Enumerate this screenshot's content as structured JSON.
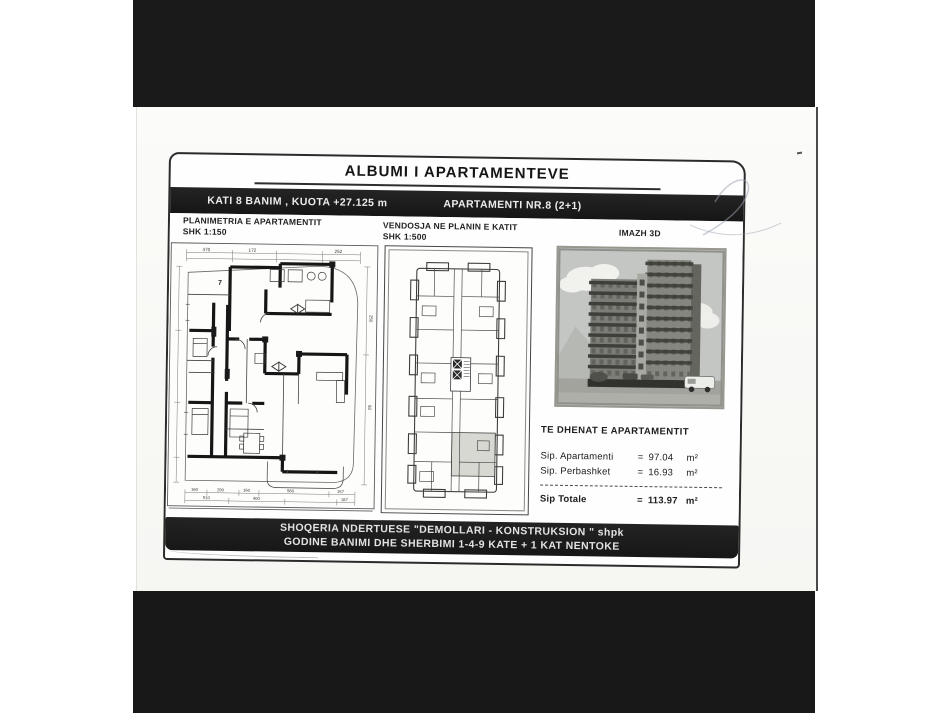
{
  "scan": {
    "background_color": "#ffffff",
    "band_color": "#1a1a1a",
    "page_color": "#fbfbf9",
    "ink_color": "#1a1a1a"
  },
  "document": {
    "title": "ALBUMI I APARTAMENTEVE",
    "header_bar": {
      "left": "KATI 8 BANIM , KUOTA +27.125 m",
      "right": "APARTAMENTI NR.8 (2+1)"
    },
    "columns": {
      "plan": {
        "title": "PLANIMETRIA E APARTAMENTIT",
        "scale": "SHK 1:150"
      },
      "key_plan": {
        "title": "VENDOSJA NE PLANIN E KATIT",
        "scale": "SHK 1:500"
      },
      "render": {
        "title": "IMAZH 3D"
      }
    },
    "apartment_data": {
      "heading": "TE DHENAT E APARTAMENTIT",
      "rows": [
        {
          "label": "Sip. Apartamenti",
          "eq": "=",
          "value": "97.04",
          "unit": "m²"
        },
        {
          "label": "Sip. Perbashket",
          "eq": "=",
          "value": "16.93",
          "unit": "m²"
        }
      ],
      "total": {
        "label": "Sip Totale",
        "eq": "=",
        "value": "113.97",
        "unit": "m²"
      }
    },
    "floor_plan": {
      "apartment_number": "7",
      "dims_top": [
        "470",
        "172",
        "252"
      ],
      "dims_right": [
        "250",
        "93"
      ],
      "dims_bottom_row1": [
        "160",
        "290",
        "160",
        "560",
        "157"
      ],
      "dims_bottom_row2": [
        "510",
        "400",
        "187"
      ]
    },
    "footer": {
      "line1": "SHOQERIA NDERTUESE \"DEMOLLARI - KONSTRUKSION \" shpk",
      "line2": "GODINE BANIMI DHE SHERBIMI 1-4-9 KATE + 1 KAT NENTOKE"
    }
  }
}
